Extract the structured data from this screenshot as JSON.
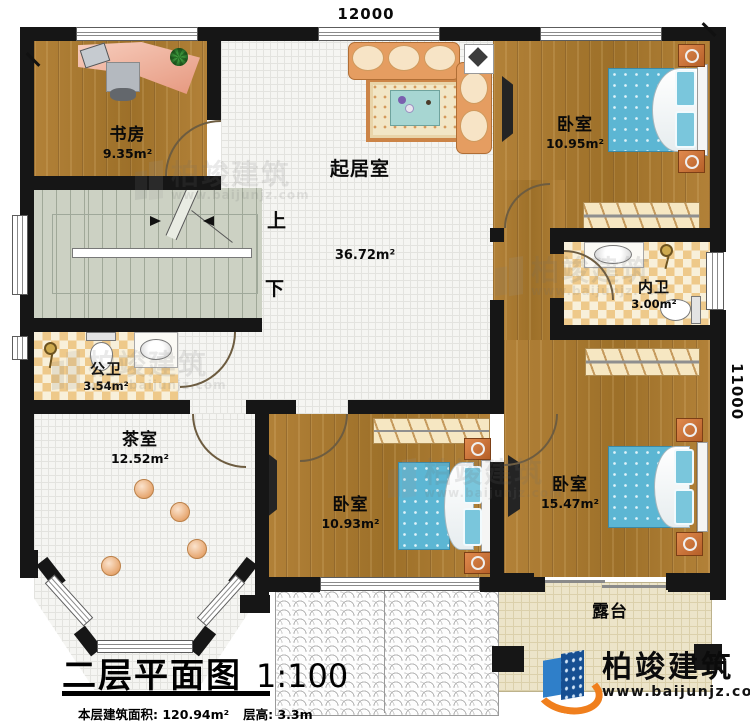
{
  "plan": {
    "title": "二层平面图",
    "scale": "1:100",
    "area_info": "本层建筑面积: 120.94m²",
    "height_info": "层高: 3.3m"
  },
  "dimensions": {
    "top": "12000",
    "right": "11000"
  },
  "stairs": {
    "up": "上",
    "down": "下"
  },
  "rooms": {
    "study": {
      "name": "书房",
      "area": "9.35m²"
    },
    "living": {
      "name": "起居室",
      "area": "36.72m²"
    },
    "bedroom_top": {
      "name": "卧室",
      "area": "10.95m²"
    },
    "inner_bath": {
      "name": "内卫",
      "area": "3.00m²"
    },
    "public_bath": {
      "name": "公卫",
      "area": "3.54m²"
    },
    "tea_room": {
      "name": "茶室",
      "area": "12.52m²"
    },
    "bedroom_mid": {
      "name": "卧室",
      "area": "10.93m²"
    },
    "bedroom_right": {
      "name": "卧室",
      "area": "15.47m²"
    },
    "terrace": {
      "name": "露台"
    }
  },
  "brand": {
    "name": "柏竣建筑",
    "url": "www.baijunjz.com"
  },
  "watermark": {
    "name": "柏竣建筑",
    "url": "www.baijunjz.com"
  },
  "colors": {
    "wall": "#161616",
    "wood": "#aa7a35",
    "tile": "#f5f5f2",
    "checker": "#eec98a",
    "stairs": "#ccd1c3",
    "bed": "#5cb6d3",
    "nightstand": "#cf7440",
    "sofa": "#e59d61",
    "desk": "#efb0a0",
    "terrace": "#ece4c9",
    "logo_blue": "#164f92",
    "logo_orange": "#f07f1d"
  }
}
